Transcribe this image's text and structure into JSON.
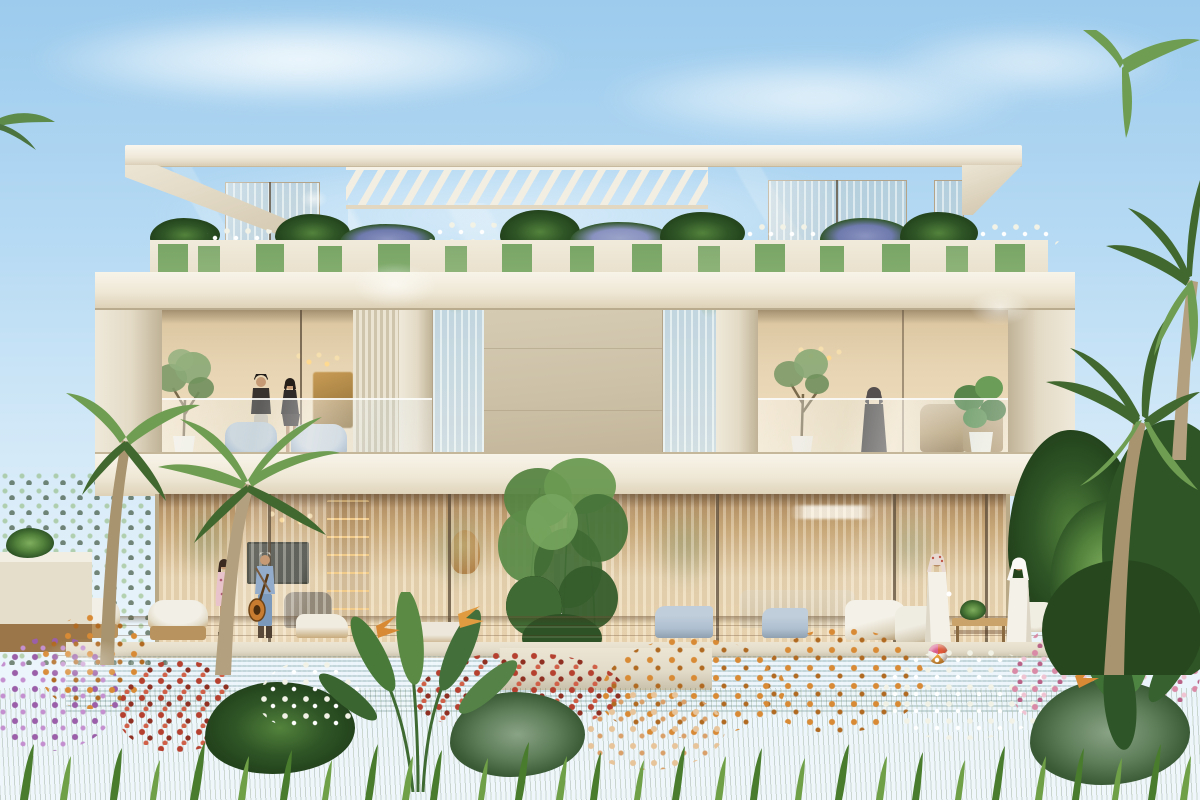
{
  "meta": {
    "title": "Architectural rendering of a modern three-storey luxury villa with roof pergola, planted terraces, pool and tropical garden",
    "type": "photorealistic exterior render",
    "time_of_day": "sunny daytime, clear sky"
  },
  "palette": {
    "sky_top": "#9ccbed",
    "sky_mid": "#cfe7f7",
    "sky_low": "#e9f4fb",
    "cloud": "#f4fafd",
    "roof_top": "#faf7ef",
    "roof_face": "#efe8d8",
    "roof_edge": "#d8cdb5",
    "soffit": "#cec2a8",
    "wall_light": "#efe9da",
    "wall_mid": "#e3dac5",
    "pier_shadow": "#bfb296",
    "parapet": "#f1ebdc",
    "stone_panel": "#cdc2a8",
    "stone_seam": "#a89a7e",
    "glass_warm": "#e7d4b2",
    "glass_deep": "#c9ad85",
    "curtain_light": "#f3e7cf",
    "interior_glow": "#f6dfae",
    "wood_shelf": "#96703f",
    "tv_screen": "#2f3733",
    "art_gold": "#c99c55",
    "sofa_gray": "#8d867a",
    "sofa_beige": "#d8cbb0",
    "chaise_blue": "#aebfd0",
    "louver_light": "#ece4d2",
    "louver_dark": "#cfc4ac",
    "deck_light": "#c39b66",
    "deck_dark": "#9e7a48",
    "coping": "#e2dbc8",
    "pool_light": "#a8d8d0",
    "pool_mid": "#5fb0a6",
    "pool_deep": "#39857d",
    "grass_light": "#8db45c",
    "grass_mid": "#6f9c46",
    "grass_dark": "#4d7a30",
    "foliage_light": "#7fae5e",
    "foliage_mid": "#53833c",
    "foliage_dark": "#2f5526",
    "palm_light": "#6f9e52",
    "palm_dark": "#41682f",
    "hedge": "#3c5f2e",
    "trunk": "#b3a07e",
    "flower_red": "#b5402f",
    "flower_pink": "#d98aa6",
    "flower_purple": "#9a5fa8",
    "flower_orange": "#d88a35",
    "flower_white": "#f2f2e6",
    "vine": "#79a566",
    "lavender": "#8a93c0",
    "kandura": "#f4f1e8",
    "ghutra_red": "#c05848",
    "denim": "#93accb",
    "jeans": "#7b99bb",
    "dress": "#e8c3cb",
    "skin": "#c59a74",
    "guitar": "#c87c30",
    "dark_fig": "#37322e",
    "hijab": "#55504f",
    "ball_red": "#e05a3a",
    "ball_orange": "#e8a03a"
  },
  "scene": {
    "sky": {
      "label": "clear light-blue sky with thin wispy clouds"
    },
    "building": {
      "label": "cream three-storey modern villa with stacked cantilevered volumes",
      "roof": {
        "label": "flat white roof slab with angled edges"
      },
      "pergola": {
        "label": "white slatted pergola over roof terrace, sky visible between slats"
      },
      "planter_band": {
        "label": "roof terrace parapet planters with lavender bushes, white flowers and trailing vines"
      },
      "top_floor": {
        "label": "recessed top floor with sheer-curtained glass windows"
      },
      "middle_floor": {
        "label": "middle floor framed by deep cream slab with two glass-railed balconies",
        "left_balcony": {
          "label": "left balcony with couple, pendant lights, gold artwork, pale-blue armchairs, potted olive tree and louvered screen"
        },
        "center": {
          "label": "central travertine stone panel flanked by two narrow warm-lit windows"
        },
        "right_balcony": {
          "label": "right balcony with standing woman, olive tree, wicker chairs and fiddle-leaf plant"
        }
      },
      "ground_floor": {
        "label": "floor-to-ceiling glass with sheer curtains, warm lit interior: TV wall, shelving, sofas and pendant lights"
      }
    },
    "pool": {
      "label": "long turquoise mosaic-tiled swimming pool with stone coping"
    },
    "deck": {
      "label": "timber pool deck with wicker lounge chairs and white sun loungers"
    },
    "garden": {
      "label": "lush foreground garden: lawn, red, pink, white and purple flower bushes, bird-of-paradise and tropical leaves"
    },
    "palms_left": {
      "label": "palm trees and green hedge at left edge"
    },
    "palms_right": {
      "label": "dense palm cluster at right edge"
    },
    "outdoor_kitchen_left": {
      "label": "white outdoor counter at far left"
    },
    "outdoor_kitchen_right": {
      "label": "outdoor kitchen with black barbecue grill at right"
    },
    "beach_ball": {
      "label": "striped beach ball at pool corner"
    },
    "people": [
      {
        "label": "man with cap and woman talking on the left balcony"
      },
      {
        "label": "woman in dark hijab standing at the right balcony railing"
      },
      {
        "label": "woman in floral dress on the deck"
      },
      {
        "label": "man in denim with sunburst guitar on his back"
      },
      {
        "label": "man in white kandura with red-checked ghutra holding a cup"
      },
      {
        "label": "man in white kandura and white ghutra near the coffee table"
      }
    ]
  }
}
